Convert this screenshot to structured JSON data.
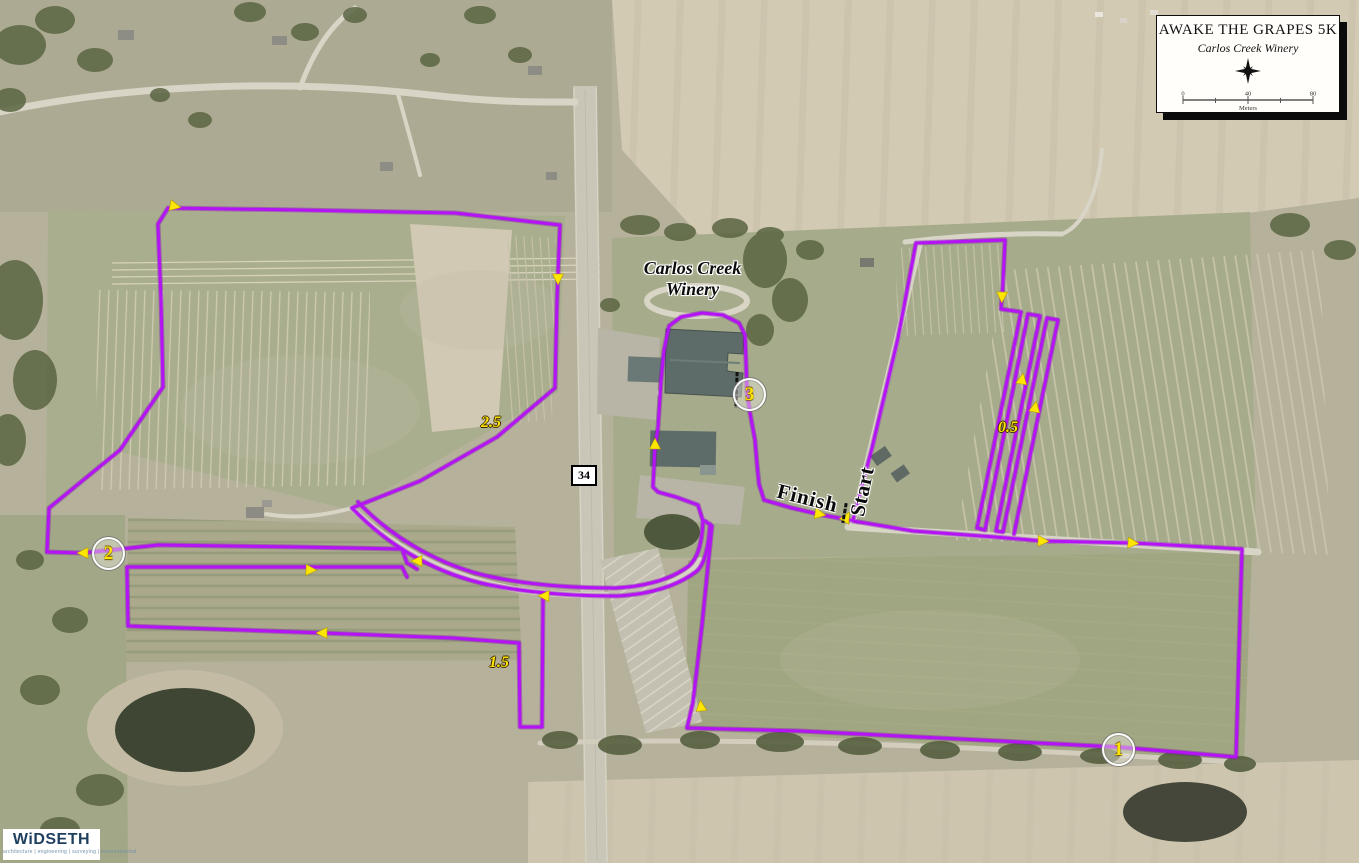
{
  "title_block": {
    "title": "AWAKE THE GRAPES 5K",
    "subtitle": "Carlos Creek Winery",
    "scale_bar": {
      "tick_left": "0",
      "tick_mid": "40",
      "tick_right": "80",
      "units": "Meters"
    }
  },
  "map_labels": {
    "winery_line1": "Carlos Creek",
    "winery_line2": "Winery",
    "start": "Start",
    "finish": "Finish",
    "highway_shield": "34"
  },
  "mile_markers": [
    {
      "label": "1"
    },
    {
      "label": "2"
    },
    {
      "label": "3"
    }
  ],
  "distance_labels": [
    {
      "label": "0.5"
    },
    {
      "label": "1.5"
    },
    {
      "label": "2.5"
    }
  ],
  "logo": {
    "name": "WiDSETH",
    "tagline": "architecture | engineering | surveying | environmental"
  },
  "colors": {
    "route": "#B414F5",
    "arrow": "#FFE600",
    "marker_text": "#FFE300"
  }
}
